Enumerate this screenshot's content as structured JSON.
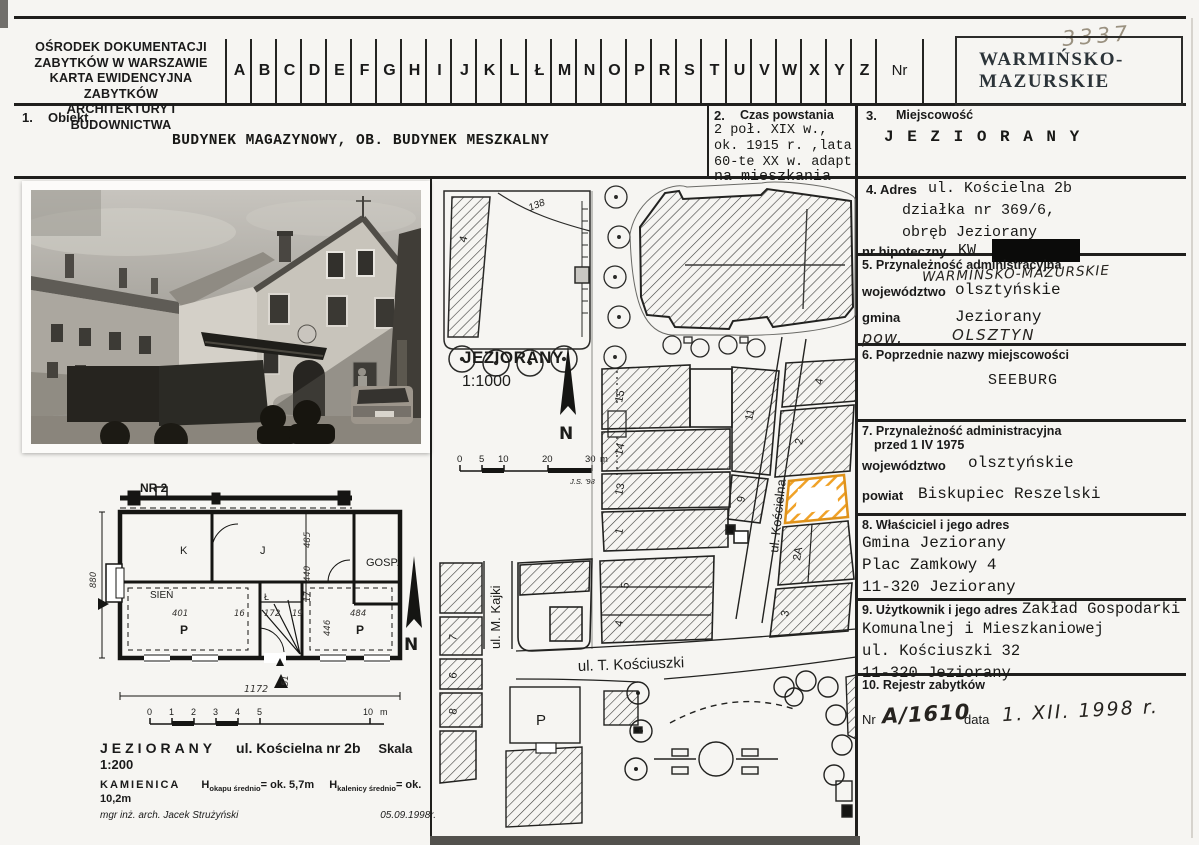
{
  "header": {
    "org_lines": [
      "OŚRODEK DOKUMENTACJI",
      "ZABYTKÓW W WARSZAWIE",
      "KARTA EWIDENCYJNA ZABYTKÓW",
      "ARCHITEKTURY I BUDOWNICTWA"
    ],
    "alphabet": [
      "A",
      "B",
      "C",
      "D",
      "E",
      "F",
      "G",
      "H",
      "I",
      "J",
      "K",
      "L",
      "Ł",
      "M",
      "N",
      "O",
      "P",
      "R",
      "S",
      "T",
      "U",
      "V",
      "W",
      "X",
      "Y",
      "Z"
    ],
    "nr_label": "Nr",
    "handwritten_number": "3337",
    "stamp_lines": [
      "WARMIŃSKO-",
      "MAZURSKIE"
    ]
  },
  "sections": {
    "s1": {
      "num": "1.",
      "title": "Obiekt",
      "value": "BUDYNEK MAGAZYNOWY, OB. BUDYNEK MESZKALNY"
    },
    "s2": {
      "num": "2.",
      "title": "Czas powstania",
      "lines": [
        "2 poł. XIX w.,",
        "ok. 1915 r. ,lata",
        "60-te XX w. adapt.",
        "na mieszkania"
      ]
    },
    "s3": {
      "num": "3.",
      "title": "Miejscowość",
      "value": "J E Z I O R A N Y"
    },
    "s4": {
      "num": "4.",
      "title": "Adres",
      "line1": "ul. Kościelna 2b",
      "line2": "działka nr 369/6,",
      "line3": "obręb Jeziorany",
      "hip_label": "nr hipoteczny",
      "kw": "KW"
    },
    "s5": {
      "title": "5. Przynależność administracyjna",
      "woj_label": "województwo",
      "woj": "olsztyńskie",
      "hand_over": "WARMIŃSKO-MAZURSKIE",
      "gmina_label": "gmina",
      "gmina": "Jeziorany",
      "pow_label": "pow.",
      "pow": "OLSZTYN"
    },
    "s6": {
      "title": "6. Poprzednie nazwy miejscowości",
      "value": "SEEBURG"
    },
    "s7": {
      "title": "7. Przynależność administracyjna",
      "title2": "przed 1 IV 1975",
      "woj_label": "województwo",
      "woj": "olsztyńskie",
      "powiat_label": "powiat",
      "powiat": "Biskupiec Reszelski"
    },
    "s8": {
      "title": "8. Właściciel i jego adres",
      "lines": [
        "Gmina Jeziorany",
        "Plac Zamkowy 4",
        "11-320 Jeziorany"
      ]
    },
    "s9": {
      "title": "9. Użytkownik i jego adres",
      "inline": "Zakład Gospodarki",
      "lines": [
        "Komunalnej i Mieszkaniowej",
        "ul. Kościuszki 32",
        "11-320 Jeziorany"
      ]
    },
    "s10": {
      "title": "10. Rejestr zabytków",
      "nr_label": "Nr",
      "nr_value": "A/1610",
      "data_label": "data",
      "data_value": "1. XII. 1998 r."
    }
  },
  "map": {
    "title": "JEZIORANY",
    "scale": "1:1000",
    "north_label": "N",
    "scalebar": {
      "t0": "0",
      "t5": "5",
      "t10": "10",
      "t20": "20",
      "t30": "30",
      "unit": "m",
      "credit": "J.S. '98"
    },
    "streets": {
      "koscielna": "ul. Kościelna",
      "kajki": "ul. M. Kajki",
      "kosciuszki": "ul. T. Kościuszki"
    },
    "labels": {
      "contour": "138",
      "b4": "4",
      "b15": "15",
      "b14": "14",
      "b13": "13",
      "b1": "1",
      "b11": "11",
      "b9": "9",
      "b2": "2",
      "b4r": "4",
      "b2a": "2A",
      "b3": "3",
      "b5": "5",
      "b4b": "4",
      "b7": "7",
      "b6": "6",
      "b8": "8",
      "parking": "P"
    },
    "highlight_color": "#f0a228"
  },
  "plan": {
    "nr": "NR 2",
    "rooms": {
      "k": "K",
      "j": "J",
      "gosp": "GOSP.",
      "sien": "SIEŃ",
      "l": "Ł",
      "p1": "P",
      "p2": "P"
    },
    "dims": {
      "d880": "880",
      "d401": "401",
      "d16": "16",
      "d172": "172",
      "d19": "19",
      "d484": "484",
      "d485": "485",
      "d440": "440",
      "d17": "17",
      "d446": "446",
      "d51": "51",
      "d1172": "1172"
    },
    "north_label": "N",
    "scalebar": {
      "t0": "0",
      "t1": "1",
      "t2": "2",
      "t3": "3",
      "t4": "4",
      "t5": "5",
      "t10": "10",
      "unit": "m"
    },
    "caption": {
      "line1_city": "JEZIORANY",
      "line1_street": "ul. Kościelna nr 2b",
      "line1_scale": "Skala 1:200",
      "type": "KAMIENICA",
      "h_prefix": "H",
      "h1_sub": "okapu średnio",
      "h1_val": "= ok. 5,7m",
      "h2_sub": "kalenicy średnio",
      "h2_val": "= ok. 10,2m",
      "author": "mgr inż. arch. Jacek Strużyński",
      "date": "05.09.1998r."
    }
  }
}
